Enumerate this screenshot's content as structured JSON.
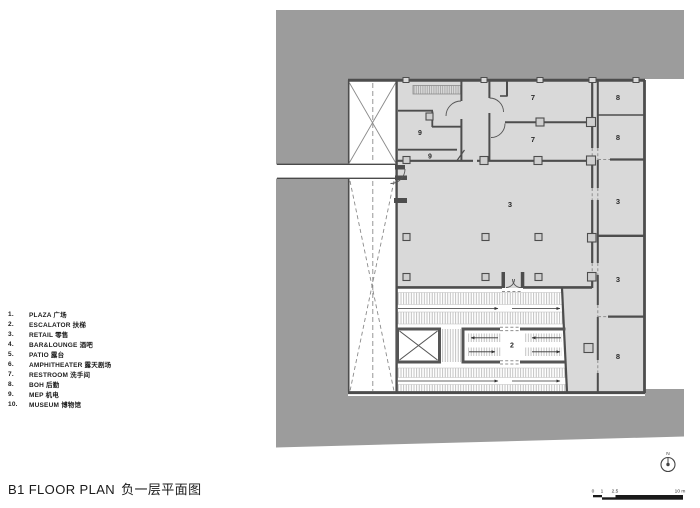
{
  "title": {
    "en": "B1 FLOOR PLAN",
    "zh": "负一层平面图"
  },
  "legend": {
    "items": [
      {
        "num": "1.",
        "label": "PLAZA 广场"
      },
      {
        "num": "2.",
        "label": "ESCALATOR 扶梯"
      },
      {
        "num": "3.",
        "label": "RETAIL 零售"
      },
      {
        "num": "4.",
        "label": "BAR&LOUNGE 酒吧"
      },
      {
        "num": "5.",
        "label": "PATIO 露台"
      },
      {
        "num": "6.",
        "label": "AMPHITHEATER 露天剧场"
      },
      {
        "num": "7.",
        "label": "RESTROOM 洗手间"
      },
      {
        "num": "8.",
        "label": "BOH 后勤"
      },
      {
        "num": "9.",
        "label": "MEP 机电"
      },
      {
        "num": "10.",
        "label": "MUSEUM 博物馆"
      }
    ]
  },
  "plan": {
    "room_labels": [
      {
        "text": "9"
      },
      {
        "text": "9"
      },
      {
        "text": "7"
      },
      {
        "text": "7"
      },
      {
        "text": "3"
      },
      {
        "text": "2"
      },
      {
        "text": "8"
      },
      {
        "text": "8"
      },
      {
        "text": "3"
      },
      {
        "text": "3"
      },
      {
        "text": "8"
      }
    ],
    "north": {
      "label": "N"
    },
    "scale_bar": {
      "labels": [
        "0",
        "1",
        "2.5",
        "10 m"
      ]
    }
  },
  "colors": {
    "context_gray": "#9c9c9c",
    "room_fill": "#d9d9d9",
    "wall": "#4d4d4d"
  }
}
